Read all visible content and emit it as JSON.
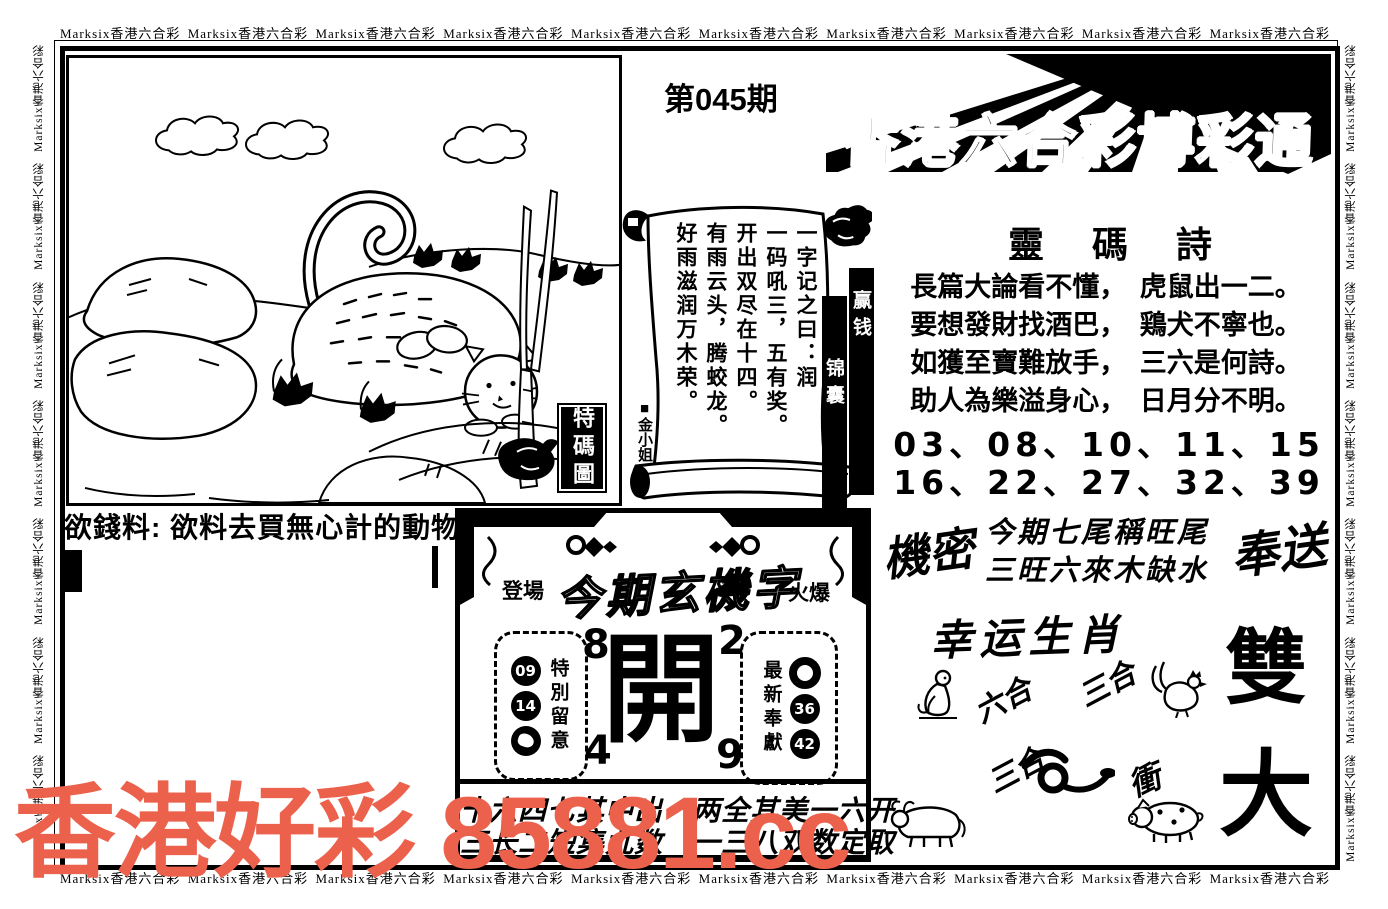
{
  "border": {
    "text": "Marksix香港六合彩",
    "h_count": 10,
    "v_count": 7
  },
  "header": {
    "issue": "第045期",
    "title": "香港六合彩博彩通"
  },
  "illustration": {
    "label": "特碼圖"
  },
  "money_clue": "欲錢料: 欲料去買無心計的動物",
  "scroll": {
    "columns": [
      "一字记之曰：润",
      "一码吼三，五有奖。",
      "开出双尽在十四。",
      "有雨云头，腾蛟龙。",
      "好雨滋润万木荣。"
    ],
    "author": "■金小姐",
    "tag_right": "赢钱",
    "tag_left": "锦囊"
  },
  "poem": {
    "title": "靈碼詩",
    "lines": [
      "長篇大論看不懂，　虎鼠出一二。",
      "要想發財找酒巴，　鶏犬不寧也。",
      "如獲至寶難放手，　三六是何詩。",
      "助人為樂溢身心，　日月分不明。"
    ],
    "numbers_line1": "03、08、10、11、15",
    "numbers_line2": "16、22、27、32、39"
  },
  "secret": {
    "left": "機密",
    "line1": "今期七尾稱旺尾",
    "line2": "三旺六來木缺水",
    "right": "奉送"
  },
  "zodiac": {
    "title": "幸运生肖",
    "label_liuhe": "六合",
    "label_sanhe1": "三合",
    "label_sanhe2": "三合",
    "label_chong": "衝",
    "animals": [
      "monkey",
      "rooster",
      "snake",
      "ox",
      "pig"
    ]
  },
  "big_chars": {
    "top": "雙",
    "bottom": "大"
  },
  "mystery": {
    "stage": "登場",
    "title": "今期玄機字",
    "hot": "火爆",
    "center": "開",
    "corners": [
      "8",
      "2",
      "4",
      "9"
    ],
    "left_box": {
      "label": "特別留意",
      "circles": [
        "09",
        "14",
        ""
      ]
    },
    "right_box": {
      "label": "最新奉獻",
      "circles": [
        "",
        "36",
        "42"
      ]
    },
    "bottom_line1": "十六四七其中出　两全其美一六开",
    "bottom_line2": "三长二短集九数　一三八双数定取"
  },
  "watermark": {
    "text": "香港好彩 85881.cc",
    "color": "#ec614c"
  }
}
